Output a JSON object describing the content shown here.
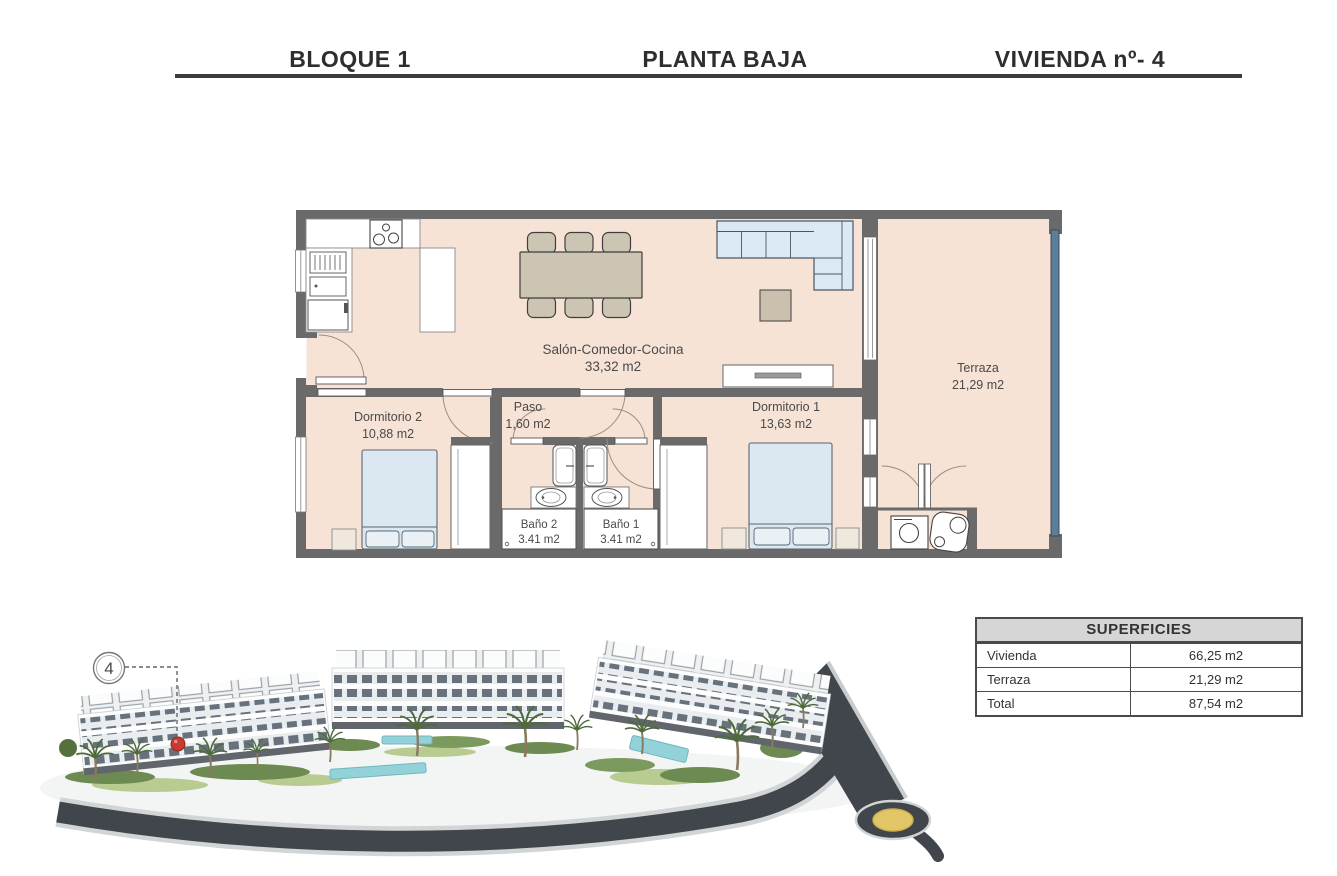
{
  "header": {
    "block": "BLOQUE 1",
    "floor": "PLANTA BAJA",
    "unit": "VIVIENDA nº- 4"
  },
  "floorplan": {
    "rooms": {
      "salon": {
        "name": "Salón-Comedor-Cocina",
        "area": "33,32 m2"
      },
      "terraza": {
        "name": "Terraza",
        "area": "21,29 m2"
      },
      "dormitorio2": {
        "name": "Dormitorio 2",
        "area": "10,88 m2"
      },
      "paso": {
        "name": "Paso",
        "area": "1,60 m2"
      },
      "dormitorio1": {
        "name": "Dormitorio 1",
        "area": "13,63 m2"
      },
      "bano2": {
        "name": "Baño 2",
        "area": "3.41 m2"
      },
      "bano1": {
        "name": "Baño 1",
        "area": "3.41 m2"
      }
    }
  },
  "site_plan": {
    "unit_marker": "4"
  },
  "surfaces_table": {
    "title": "SUPERFICIES",
    "rows": [
      {
        "label": "Vivienda",
        "value": "66,25 m2"
      },
      {
        "label": "Terraza",
        "value": "21,29 m2"
      },
      {
        "label": "Total",
        "value": "87,54 m2"
      }
    ]
  },
  "colors": {
    "floor_fill": "#f6e3d6",
    "wall": "#6a6a6a",
    "terrace_glass": "#5b7e9b",
    "furniture_blue": "#dbe9f4",
    "furniture_tan": "#cdc5b4",
    "marker_red": "#c63a2f",
    "roundabout_yellow": "#e2c566",
    "road": "#41464c"
  }
}
